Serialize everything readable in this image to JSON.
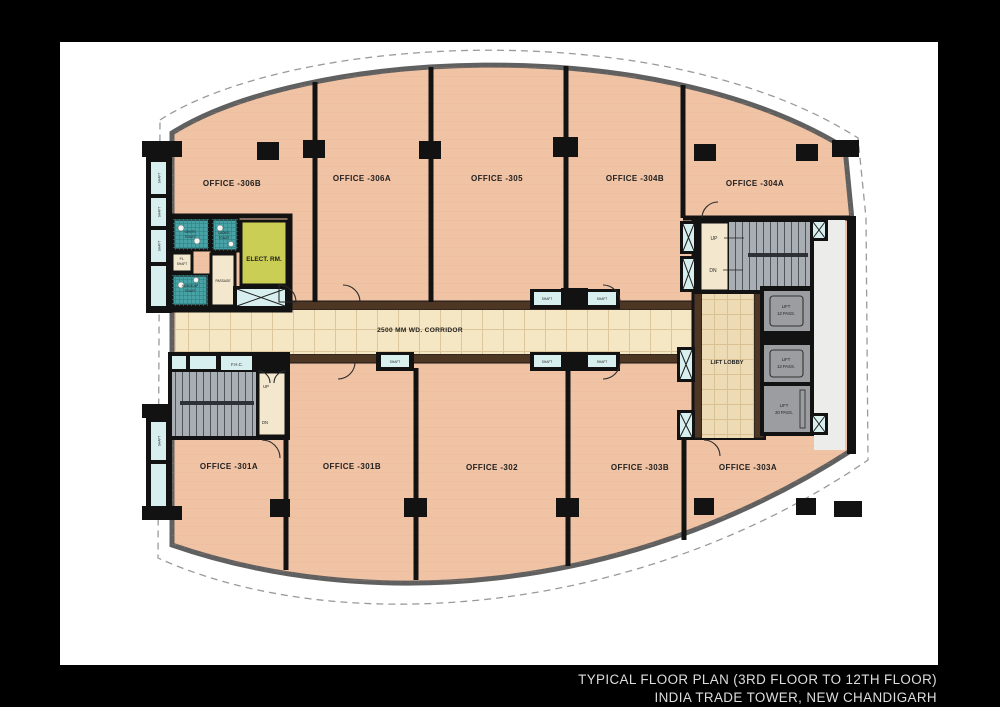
{
  "title": {
    "line1": "TYPICAL FLOOR PLAN (3RD FLOOR TO 12TH FLOOR)",
    "line2": "INDIA TRADE TOWER, NEW CHANDIGARH"
  },
  "rooms": {
    "o306b": "OFFICE -306B",
    "o306a": "OFFICE -306A",
    "o305": "OFFICE -305",
    "o304b": "OFFICE -304B",
    "o304a": "OFFICE -304A",
    "o301a": "OFFICE -301A",
    "o301b": "OFFICE -301B",
    "o302": "OFFICE -302",
    "o303b": "OFFICE -303B",
    "o303a": "OFFICE -303A"
  },
  "labels": {
    "corridor": "2500 MM WD. CORRIDOR",
    "lift_lobby": "LIFT LOBBY",
    "lift": "LIFT",
    "pass13": "13 PASS.",
    "pass20": "20 PASS.",
    "elect": "ELECT. RM.",
    "up": "UP",
    "dn": "DN",
    "fhc": "F.H.C.",
    "passage": "PASSAGE",
    "shaft": "SHAFT",
    "pl": "PL.",
    "gents": "GENTS",
    "ladies": "LADIES",
    "handicap": "HANDICAP",
    "toilet": "TOILET"
  },
  "colors": {
    "frame_bg": "#000000",
    "page_bg": "#ffffff",
    "office_fill": "#f1c3a5",
    "corridor_fill": "#f5e7c3",
    "lobby_fill": "#ecdbb5",
    "vestibule_fill": "#f3e8cd",
    "toilet_fill": "#47a3a5",
    "elect_fill": "#cbce55",
    "stair_fill": "#a9aeb5",
    "lift_fill": "#9b9da0",
    "shaft_fill": "#d7efee",
    "wall": "#121212",
    "corridor_wall": "#4e3625",
    "outline": "#606060",
    "title_text": "#dedede"
  }
}
